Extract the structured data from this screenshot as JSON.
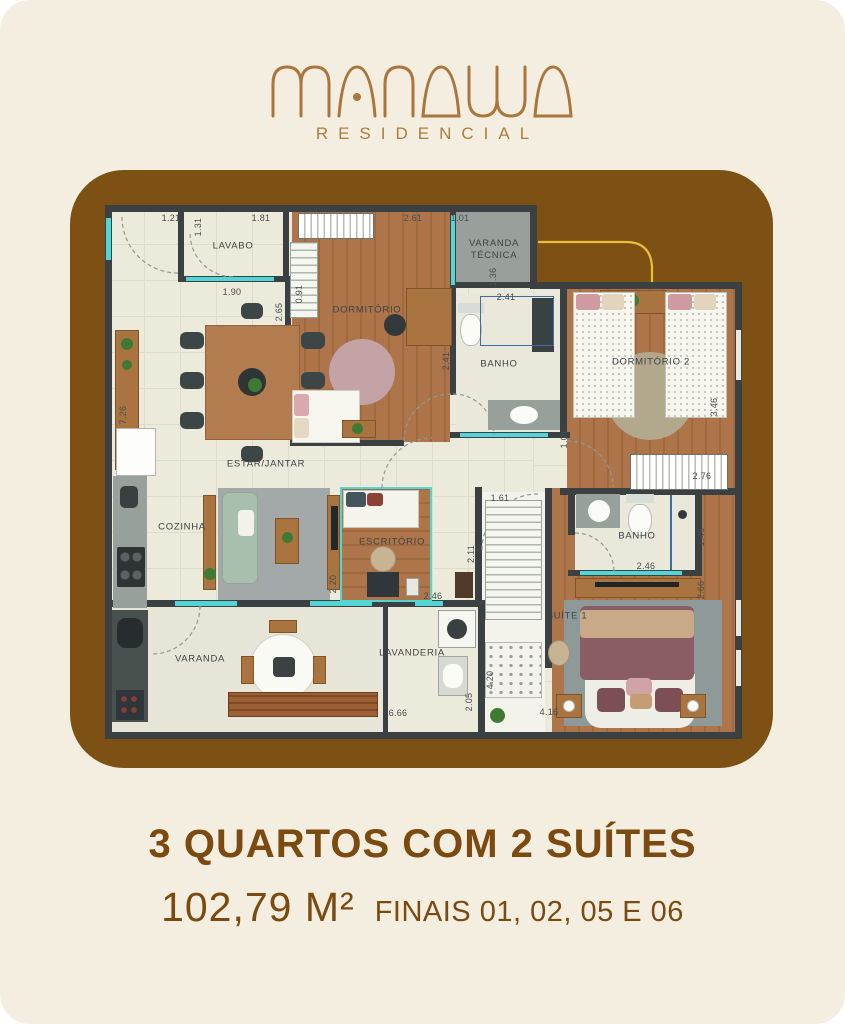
{
  "logo": {
    "brand": "MANAWA",
    "tagline": "RESIDENCIAL",
    "color": "#a9763b"
  },
  "colors": {
    "background": "#f3eee0",
    "card": "#7d5114",
    "text_brown": "#7b4a10",
    "wall": "#3b4142",
    "glass_cyan": "#52d5d5",
    "swirl_yellow": "#ecbf3a"
  },
  "plan": {
    "rooms": [
      {
        "id": "lavabo",
        "label": "LAVABO"
      },
      {
        "id": "dormitorio-1",
        "label": "DORMITÓRIO"
      },
      {
        "id": "varanda-tecnica",
        "label": "VARANDA TÉCNICA"
      },
      {
        "id": "banho-1",
        "label": "BANHO"
      },
      {
        "id": "dormitorio-2",
        "label": "DORMITÓRIO 2"
      },
      {
        "id": "estar-jantar",
        "label": "ESTAR/JANTAR"
      },
      {
        "id": "cozinha",
        "label": "COZINHA"
      },
      {
        "id": "escritorio",
        "label": "ESCRITÓRIO"
      },
      {
        "id": "banho-suite",
        "label": "BANHO"
      },
      {
        "id": "suite-1",
        "label": "SUÍTE 1"
      },
      {
        "id": "varanda",
        "label": "VARANDA"
      },
      {
        "id": "lavanderia",
        "label": "LAVANDERIA"
      }
    ],
    "dimensions": [
      {
        "value": "1.21"
      },
      {
        "value": "1.31"
      },
      {
        "value": "1.81"
      },
      {
        "value": "1.90"
      },
      {
        "value": "2.65"
      },
      {
        "value": "2.61"
      },
      {
        "value": "1.01"
      },
      {
        "value": "1.36"
      },
      {
        "value": "0.91"
      },
      {
        "value": "2.41"
      },
      {
        "value": "2.41"
      },
      {
        "value": "7.26"
      },
      {
        "value": "1.01"
      },
      {
        "value": "3.46"
      },
      {
        "value": "2.76"
      },
      {
        "value": "2.20"
      },
      {
        "value": "1.61"
      },
      {
        "value": "2.11"
      },
      {
        "value": "2.46"
      },
      {
        "value": "2.46"
      },
      {
        "value": "1.46"
      },
      {
        "value": "2.66"
      },
      {
        "value": "4.20"
      },
      {
        "value": "2.05"
      },
      {
        "value": "6.66"
      },
      {
        "value": "4.16"
      }
    ]
  },
  "footer": {
    "headline": "3 QUARTOS COM 2 SUÍTES",
    "area": "102,79 M²",
    "units": "FINAIS 01, 02, 05 E 06"
  }
}
